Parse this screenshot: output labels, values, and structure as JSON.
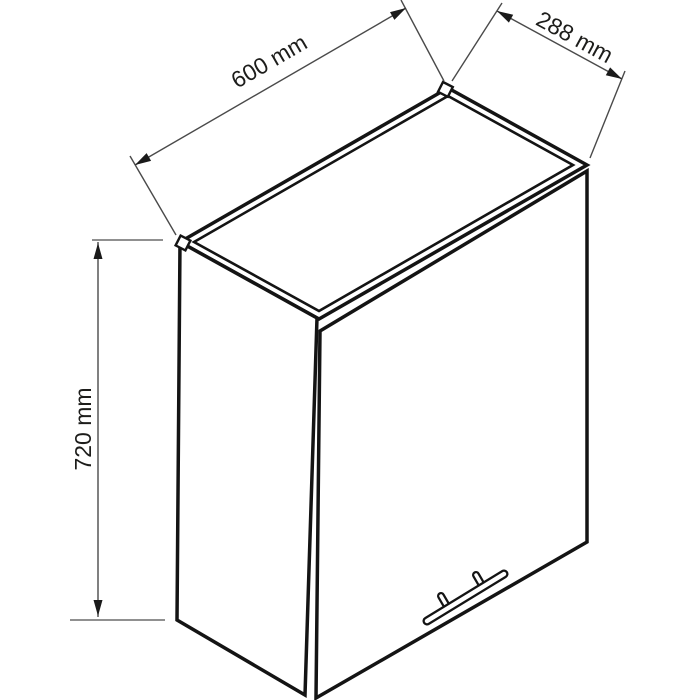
{
  "diagram": {
    "dimensions": {
      "width": {
        "label": "600 mm",
        "value": 600,
        "unit": "mm"
      },
      "depth": {
        "label": "288 mm",
        "value": 288,
        "unit": "mm"
      },
      "height": {
        "label": "720 mm",
        "value": 720,
        "unit": "mm"
      }
    },
    "colors": {
      "line": "#141414",
      "dimension_line": "#4a4a4a",
      "background": "#ffffff"
    }
  }
}
